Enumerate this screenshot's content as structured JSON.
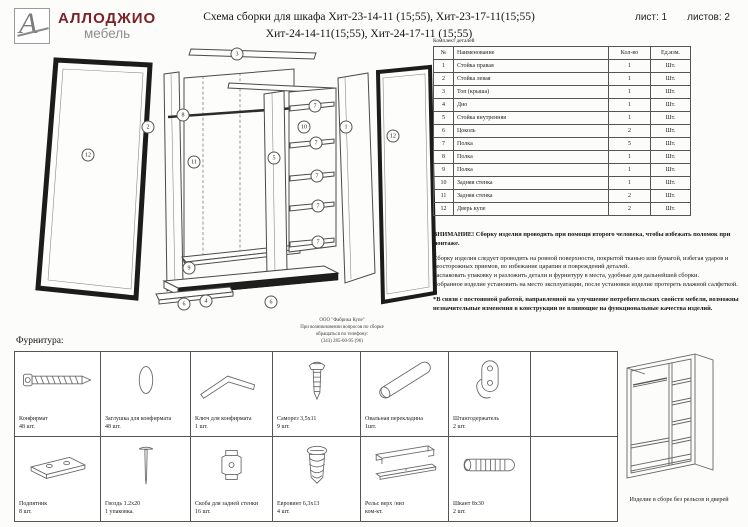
{
  "header": {
    "logo_monogram": "А",
    "brand": "АЛЛОДЖИО",
    "brand_sub": "мебель",
    "title_line1": "Схема сборки для шкафа Хит-23-14-11 (15;55), Хит-23-17-11(15;55)",
    "title_line2": "Хит-24-14-11(15;55), Хит-24-17-11 (15;55)",
    "sheet_label": "лист: 1",
    "sheets_label": "листов: 2"
  },
  "parts_table": {
    "caption": "Комплект деталей",
    "columns": {
      "num": "№",
      "name": "Наименование",
      "qty": "Кол-во",
      "unit": "Ед.изм."
    },
    "rows": [
      {
        "num": "1",
        "name": "Стойка правая",
        "qty": "1",
        "unit": "Шт."
      },
      {
        "num": "2",
        "name": "Стойка левая",
        "qty": "1",
        "unit": "Шт."
      },
      {
        "num": "3",
        "name": "Топ (крыша)",
        "qty": "1",
        "unit": "Шт."
      },
      {
        "num": "4",
        "name": "Дно",
        "qty": "1",
        "unit": "Шт."
      },
      {
        "num": "5",
        "name": "Стойка внутренняя",
        "qty": "1",
        "unit": "Шт."
      },
      {
        "num": "6",
        "name": "Цоколь",
        "qty": "2",
        "unit": "Шт."
      },
      {
        "num": "7",
        "name": "Полка",
        "qty": "5",
        "unit": "Шт."
      },
      {
        "num": "8",
        "name": "Полка",
        "qty": "1",
        "unit": "Шт."
      },
      {
        "num": "9",
        "name": "Полка",
        "qty": "1",
        "unit": "Шт."
      },
      {
        "num": "10",
        "name": "Задняя стенка",
        "qty": "1",
        "unit": "Шт."
      },
      {
        "num": "11",
        "name": "Задняя стенка",
        "qty": "2",
        "unit": "Шт."
      },
      {
        "num": "12",
        "name": "Дверь купе",
        "qty": "2",
        "unit": "Шт."
      }
    ]
  },
  "notes": {
    "warning": "ВНИМАНИЕ! Сборку изделия проводить при помощи второго человека, чтобы избежать поломок при монтаже.",
    "p1": "Сборку изделия следует проводить на ровной поверхности, покрытой тканью или бумагой, избегая ударов и неосторожных приемов, во избежание царапин и повреждений деталей.",
    "p2": "Распаковать упаковку и разложить детали и фурнитуру в места, удобные для дальнейшей сборки.",
    "p3": "Собранное изделие установить на место эксплуатации, после установки изделие протереть влажной салфеткой.",
    "p4": "*В связи с постоянной работой, направленной на улучшение потребительских свойств мебели, возможны незначительные изменения в конструкции не влияющие на функциональные качества изделий."
  },
  "factory_note": {
    "line1": "ООО \"Фабрика Купе\"",
    "line2": "При возникновении вопросов по сборке",
    "line3": "обращаться по телефону:",
    "line4": "(343) 285-00-95 (96)"
  },
  "diagram": {
    "balloons": [
      {
        "n": "12"
      },
      {
        "n": "2"
      },
      {
        "n": "8"
      },
      {
        "n": "11"
      },
      {
        "n": "9"
      },
      {
        "n": "3"
      },
      {
        "n": "5"
      },
      {
        "n": "10"
      },
      {
        "n": "7"
      },
      {
        "n": "7"
      },
      {
        "n": "7"
      },
      {
        "n": "7"
      },
      {
        "n": "7"
      },
      {
        "n": "1"
      },
      {
        "n": "12"
      },
      {
        "n": "6"
      },
      {
        "n": "4"
      },
      {
        "n": "6"
      }
    ]
  },
  "hardware": {
    "heading": "Фурнитура:",
    "items": [
      {
        "name": "Конфирмат",
        "qty": "48 шт."
      },
      {
        "name": "Заглушка для конфирмата",
        "qty": "48 шт."
      },
      {
        "name": "Ключ для конфирмата",
        "qty": "1 шт."
      },
      {
        "name": "Саморез 3,5х11",
        "qty": "9 шт."
      },
      {
        "name": "Овальная перекладина",
        "qty": "1шт."
      },
      {
        "name": "Штангодержатель",
        "qty": "2 шт."
      },
      {
        "name": "Подпятник",
        "qty": "8 шт."
      },
      {
        "name": "Гвоздь 1.2х20",
        "qty": "1 упаковка."
      },
      {
        "name": "Скоба для задней стенки",
        "qty": "16 шт."
      },
      {
        "name": "Евровинт 6,3х13",
        "qty": "4 шт."
      },
      {
        "name": "Рельс верх /низ",
        "qty": "ком-кт."
      },
      {
        "name": "Шкант 8х30",
        "qty": "2 шт."
      }
    ]
  },
  "assembled_view": {
    "caption": "Изделие в сборе без рельсов и дверей"
  }
}
